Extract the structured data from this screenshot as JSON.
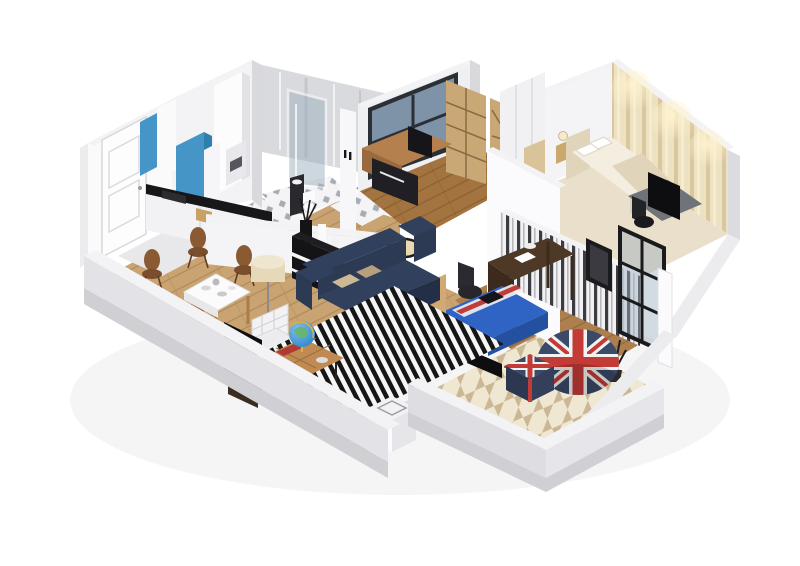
{
  "scene": {
    "type": "isometric-3d-floorplan-render",
    "description": "Cutaway 3D isometric render of an apartment: entry hall, kitchen, bathroom, study, master bedroom, living-dining room, second bedroom and balcony",
    "rooms": [
      {
        "name": "entry-hall",
        "floor": "light-gray",
        "furniture": [
          "white-paneled-entry-door"
        ]
      },
      {
        "name": "kitchen",
        "floor": "diamond-tile",
        "furniture": [
          "blue-cabinet-panels",
          "black-countertop",
          "sink",
          "range-hood",
          "tall-white-cabinet"
        ]
      },
      {
        "name": "bathroom",
        "floor": "diamond-tile",
        "furniture": [
          "glass-shower",
          "dark-vanity",
          "toilet"
        ]
      },
      {
        "name": "study",
        "floor": "dark-wood-planks",
        "furniture": [
          "large-window",
          "l-shaped-desk",
          "monitor",
          "wood-bookshelf",
          "diamond-shelf"
        ]
      },
      {
        "name": "master-bedroom",
        "floor": "light-carpet",
        "furniture": [
          "bed-with-pillows",
          "nightstand-lamp",
          "closet",
          "tv-dresser",
          "black-chair"
        ],
        "wall": "warm-striped-wallpaper-with-lamps"
      },
      {
        "name": "living-dining",
        "floor": "light-wood-planks",
        "furniture": [
          "navy-sofa",
          "striped-rug",
          "coffee-table-with-globe",
          "dining-table",
          "four-brown-chairs",
          "white-lounge-chair",
          "tv-screen",
          "black-console-with-vases",
          "drum-floor-lamp",
          "arc-floor-lamp"
        ]
      },
      {
        "name": "second-bedroom",
        "floor": "wood-planks",
        "furniture": [
          "dark-desk",
          "desk-chair",
          "blue-union-jack-bed",
          "wood-wardrobe",
          "white-shelf-unit",
          "wall-tv"
        ],
        "wall": "black-white-striped-wallpaper"
      },
      {
        "name": "balcony",
        "floor": "beige-pinwheel-tile",
        "furniture": [
          "union-jack-beanbag",
          "union-jack-ottoman",
          "dry-plant",
          "black-frame-glazing"
        ]
      }
    ]
  },
  "colors": {
    "bg": "#ffffff",
    "wall-top": "#f3f3f5",
    "wall-bright": "#fafafb",
    "wall-mid": "#ececef",
    "wall-shade": "#d8d8dd",
    "wall-outer": "#e3e3e7",
    "slab": "#cfcfd4",
    "floor-wood-light": "#c9a472",
    "plank-line": "#b08a58",
    "floor-wood-dark": "#a3743f",
    "plank-line-dark": "#8a5f33",
    "floor-wood-mid": "#ad7f4e",
    "plank-line-mid": "#93683c",
    "tile-base": "#f4f4f6",
    "tile-diamond": "#8e949c",
    "balcony-tile-a": "#efe7d2",
    "balcony-tile-b": "#cbb794",
    "counter-black": "#17171a",
    "cabinet-blue": "#4596c7",
    "cabinet-blue-dark": "#2f7fae",
    "sofa-navy": "#2c3a54",
    "sofa-navy-dark": "#222f46",
    "sofa-navy-light": "#31405c",
    "cushion-beige": "#cbb894",
    "rug-white": "#f5f5f5",
    "rug-black": "#161616",
    "table-wood": "#c08b52",
    "globe-blue": "#2e86c8",
    "uk-red": "#c23b36",
    "uk-blue": "#3b4a68",
    "uk-white": "#f2f2f2",
    "bed-cream": "#f3eee0",
    "bed-cream-dark": "#e0d5bb",
    "wallpaper-base": "#ece1c2",
    "wallpaper-stripe": "#d9c89e",
    "stripe-dark": "#3c3c40",
    "desk-dark": "#4e3826",
    "chair-brown": "#8a5a33",
    "bed2-blue": "#2f63c4",
    "bed2-blue-dark": "#2450a0",
    "tv-black": "#0e0e10",
    "shelf-wood": "#c9a876",
    "shelf-wood-dark": "#8a6b42",
    "wardrobe-wood": "#d2a972",
    "glass-blue": "#9db0bf",
    "frame-black": "#1a1a1d",
    "metal-gray": "#d9dadd",
    "floor-entry": "#e8e8ea",
    "floor-master": "#e9dfca",
    "gray-desk": "#70747a",
    "lamp-beige": "#ead9ae"
  }
}
